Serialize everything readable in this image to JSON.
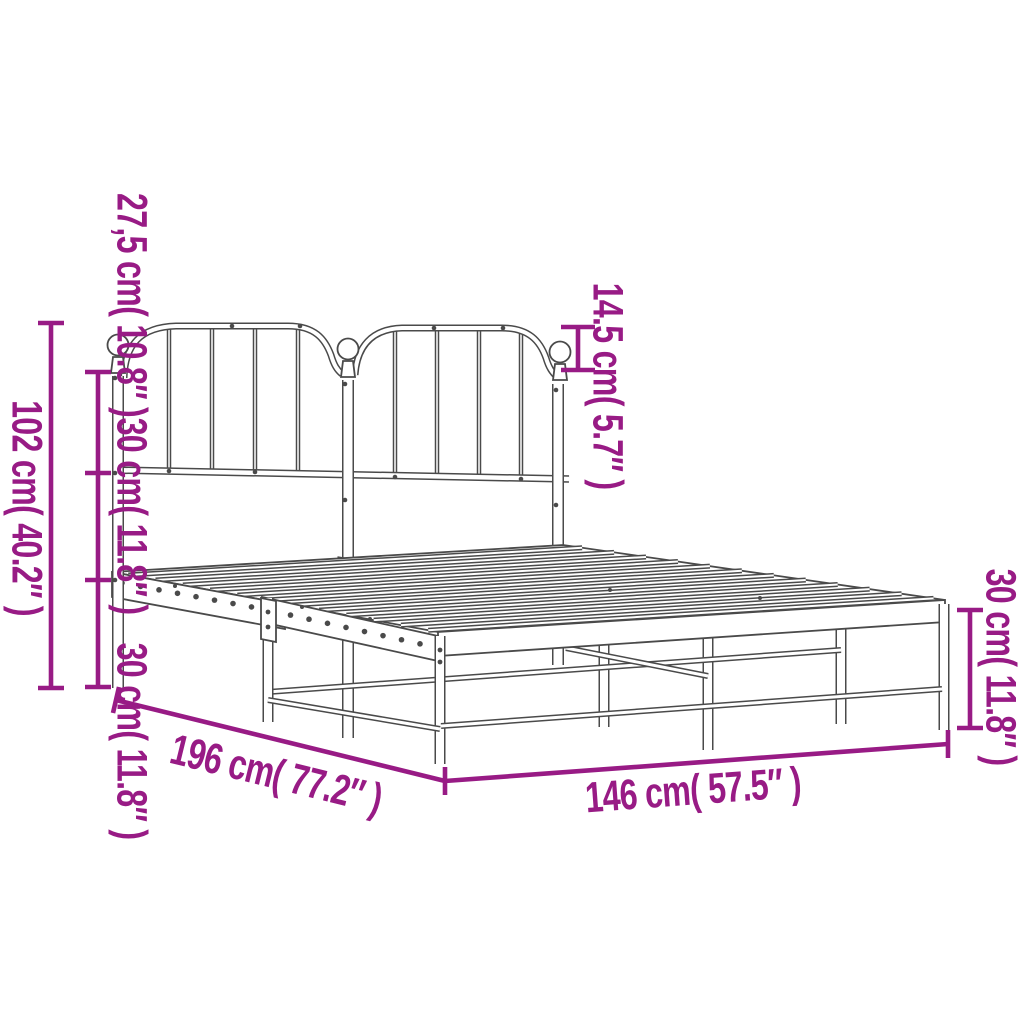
{
  "colors": {
    "dimension_accent": "#981b85",
    "line_art": "#4a4a4a",
    "background": "#ffffff"
  },
  "diagram": {
    "subject": "metal bed frame with headboard",
    "dimensions": {
      "headboard_top_segment": "27,5 cm( 10.8″ )",
      "headboard_upper_segment": "30 cm( 11.8″ )",
      "headboard_lower_segment": "30 cm( 11.8″ )",
      "headboard_total_height": "102 cm( 40.2″ )",
      "finial_height": "14.5 cm( 5.7″ )",
      "leg_height": "30 cm( 11.8″ )",
      "bed_length": "196 cm( 77.2″ )",
      "bed_width": "146 cm( 57.5″ )"
    }
  }
}
